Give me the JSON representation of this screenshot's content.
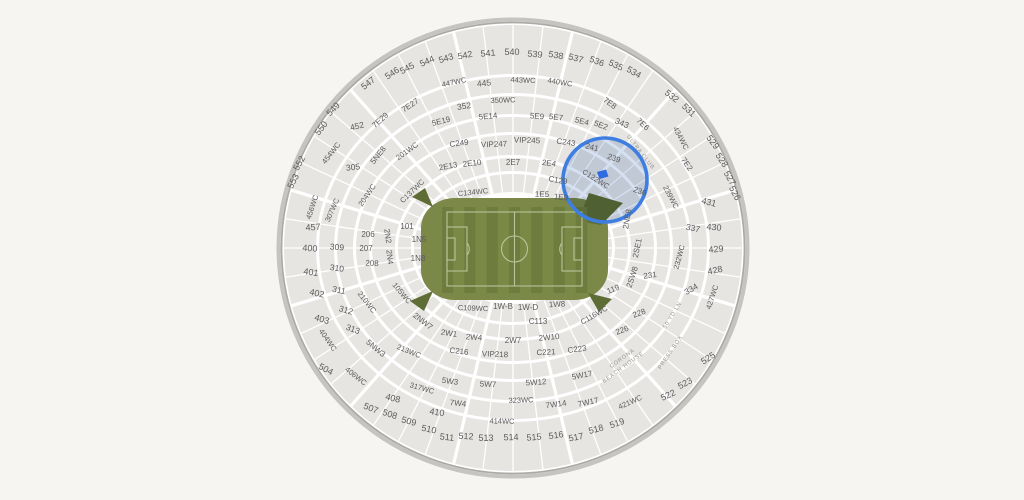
{
  "map": {
    "venue_hint": "stadium-seat-map",
    "colors": {
      "background": "#f7f5f1",
      "bowl_base": "#ffffff",
      "section_fill": "#e7e5e2",
      "rim_outer": "#c6c4c1",
      "rim_inner": "#abaaa7",
      "label": "#5b5b5b",
      "amenity_label": "#97948e",
      "field_apron": "#7b8847",
      "stripe_a": "#6e7c3d",
      "stripe_b": "#7a8946",
      "field_lines": "#b9c49b",
      "ramp": "#5e6d35"
    },
    "highlight": {
      "cx": 605,
      "cy": 180,
      "r": 42,
      "ring_color": "#3e7ee2",
      "tint_color": "#b9cbe7",
      "marker_color": "#2c6be2",
      "sections": [
        "241",
        "239",
        "C122WC"
      ]
    },
    "labels": [
      {
        "t": "546",
        "x": 392,
        "y": 73,
        "r": -33,
        "s": 9
      },
      {
        "t": "545",
        "x": 407,
        "y": 68,
        "r": -28,
        "s": 9
      },
      {
        "t": "544",
        "x": 427,
        "y": 61,
        "r": -23,
        "s": 9
      },
      {
        "t": "543",
        "x": 446,
        "y": 58,
        "r": -17,
        "s": 9
      },
      {
        "t": "542",
        "x": 465,
        "y": 55,
        "r": -11,
        "s": 9
      },
      {
        "t": "541",
        "x": 488,
        "y": 53,
        "r": -5,
        "s": 9
      },
      {
        "t": "540",
        "x": 512,
        "y": 52,
        "r": 0,
        "s": 9
      },
      {
        "t": "539",
        "x": 535,
        "y": 54,
        "r": 5,
        "s": 9
      },
      {
        "t": "538",
        "x": 556,
        "y": 55,
        "r": 10,
        "s": 9
      },
      {
        "t": "537",
        "x": 576,
        "y": 58,
        "r": 15,
        "s": 9
      },
      {
        "t": "536",
        "x": 597,
        "y": 61,
        "r": 20,
        "s": 9
      },
      {
        "t": "535",
        "x": 616,
        "y": 65,
        "r": 25,
        "s": 9
      },
      {
        "t": "534",
        "x": 634,
        "y": 72,
        "r": 30,
        "s": 9
      },
      {
        "t": "547",
        "x": 368,
        "y": 83,
        "r": -38,
        "s": 9
      },
      {
        "t": "549",
        "x": 333,
        "y": 109,
        "r": -47,
        "s": 9
      },
      {
        "t": "550",
        "x": 321,
        "y": 128,
        "r": -52,
        "s": 9
      },
      {
        "t": "552",
        "x": 299,
        "y": 163,
        "r": -60,
        "s": 9
      },
      {
        "t": "553",
        "x": 293,
        "y": 181,
        "r": -63,
        "s": 9
      },
      {
        "t": "532",
        "x": 672,
        "y": 96,
        "r": 38,
        "s": 9
      },
      {
        "t": "531",
        "x": 689,
        "y": 110,
        "r": 44,
        "s": 9
      },
      {
        "t": "529",
        "x": 713,
        "y": 142,
        "r": 53,
        "s": 9
      },
      {
        "t": "528",
        "x": 722,
        "y": 160,
        "r": 57,
        "s": 9
      },
      {
        "t": "527",
        "x": 730,
        "y": 178,
        "r": 60,
        "s": 9
      },
      {
        "t": "526",
        "x": 735,
        "y": 193,
        "r": 63,
        "s": 9
      },
      {
        "t": "504",
        "x": 326,
        "y": 369,
        "r": 28,
        "s": 9
      },
      {
        "t": "507",
        "x": 371,
        "y": 408,
        "r": 22,
        "s": 9
      },
      {
        "t": "508",
        "x": 390,
        "y": 414,
        "r": 18,
        "s": 9
      },
      {
        "t": "509",
        "x": 409,
        "y": 421,
        "r": 15,
        "s": 9
      },
      {
        "t": "510",
        "x": 429,
        "y": 429,
        "r": 11,
        "s": 9
      },
      {
        "t": "511",
        "x": 447,
        "y": 437,
        "r": 6,
        "s": 9
      },
      {
        "t": "512",
        "x": 466,
        "y": 436,
        "r": 3,
        "s": 9
      },
      {
        "t": "513",
        "x": 486,
        "y": 438,
        "r": 0,
        "s": 9
      },
      {
        "t": "514",
        "x": 511,
        "y": 437,
        "r": -2,
        "s": 9
      },
      {
        "t": "515",
        "x": 534,
        "y": 437,
        "r": -5,
        "s": 9
      },
      {
        "t": "516",
        "x": 556,
        "y": 435,
        "r": -8,
        "s": 9
      },
      {
        "t": "517",
        "x": 576,
        "y": 437,
        "r": -11,
        "s": 9
      },
      {
        "t": "518",
        "x": 596,
        "y": 429,
        "r": -15,
        "s": 9
      },
      {
        "t": "519",
        "x": 617,
        "y": 423,
        "r": -19,
        "s": 9
      },
      {
        "t": "522",
        "x": 668,
        "y": 395,
        "r": -25,
        "s": 9
      },
      {
        "t": "523",
        "x": 685,
        "y": 383,
        "r": -28,
        "s": 9
      },
      {
        "t": "525",
        "x": 708,
        "y": 358,
        "r": -33,
        "s": 9
      },
      {
        "t": "400",
        "x": 310,
        "y": 248,
        "r": 4,
        "s": 9
      },
      {
        "t": "401",
        "x": 311,
        "y": 272,
        "r": 8,
        "s": 9
      },
      {
        "t": "402",
        "x": 317,
        "y": 293,
        "r": 12,
        "s": 9
      },
      {
        "t": "403",
        "x": 322,
        "y": 319,
        "r": 17,
        "s": 9
      },
      {
        "t": "457",
        "x": 313,
        "y": 227,
        "r": -4,
        "s": 9
      },
      {
        "t": "408",
        "x": 393,
        "y": 398,
        "r": 14,
        "s": 9
      },
      {
        "t": "410",
        "x": 437,
        "y": 412,
        "r": 9,
        "s": 9
      },
      {
        "t": "428",
        "x": 715,
        "y": 270,
        "r": -12,
        "s": 9
      },
      {
        "t": "429",
        "x": 716,
        "y": 249,
        "r": -5,
        "s": 9
      },
      {
        "t": "430",
        "x": 714,
        "y": 227,
        "r": 5,
        "s": 9
      },
      {
        "t": "431",
        "x": 709,
        "y": 202,
        "r": 14,
        "s": 9
      },
      {
        "t": "305",
        "x": 353,
        "y": 167,
        "r": -6,
        "s": 8.5
      },
      {
        "t": "309",
        "x": 337,
        "y": 247,
        "r": 5,
        "s": 8.5
      },
      {
        "t": "310",
        "x": 337,
        "y": 268,
        "r": 8,
        "s": 8.5
      },
      {
        "t": "311",
        "x": 339,
        "y": 290,
        "r": 12,
        "s": 8.5
      },
      {
        "t": "312",
        "x": 346,
        "y": 310,
        "r": 16,
        "s": 8.5
      },
      {
        "t": "313",
        "x": 353,
        "y": 329,
        "r": 20,
        "s": 8.5
      },
      {
        "t": "334",
        "x": 691,
        "y": 289,
        "r": -30,
        "s": 8.5
      },
      {
        "t": "337",
        "x": 693,
        "y": 228,
        "r": 12,
        "s": 8.5
      },
      {
        "t": "343",
        "x": 622,
        "y": 123,
        "r": 24,
        "s": 8.5
      },
      {
        "t": "352",
        "x": 464,
        "y": 106,
        "r": -8,
        "s": 8.5
      },
      {
        "t": "445",
        "x": 484,
        "y": 83,
        "r": -6,
        "s": 8.5
      },
      {
        "t": "452",
        "x": 357,
        "y": 126,
        "r": -14,
        "s": 8.5
      },
      {
        "t": "447WC",
        "x": 454,
        "y": 82,
        "r": -12,
        "s": 7.5
      },
      {
        "t": "443WC",
        "x": 523,
        "y": 80,
        "r": 2,
        "s": 7.5
      },
      {
        "t": "440WC",
        "x": 560,
        "y": 82,
        "r": 9,
        "s": 7.5
      },
      {
        "t": "434WC",
        "x": 681,
        "y": 138,
        "r": 62,
        "s": 7.5
      },
      {
        "t": "427WC",
        "x": 712,
        "y": 297,
        "r": -72,
        "s": 7.5
      },
      {
        "t": "421WC",
        "x": 630,
        "y": 402,
        "r": -24,
        "s": 7.5
      },
      {
        "t": "414WC",
        "x": 502,
        "y": 421,
        "r": 1,
        "s": 7.5
      },
      {
        "t": "406WC",
        "x": 356,
        "y": 376,
        "r": 38,
        "s": 7.5
      },
      {
        "t": "404WC",
        "x": 328,
        "y": 340,
        "r": 55,
        "s": 7.5
      },
      {
        "t": "454WC",
        "x": 331,
        "y": 153,
        "r": -52,
        "s": 7.5
      },
      {
        "t": "456WC",
        "x": 312,
        "y": 207,
        "r": -72,
        "s": 7.5
      },
      {
        "t": "350WC",
        "x": 503,
        "y": 100,
        "r": -2,
        "s": 7.5
      },
      {
        "t": "317WC",
        "x": 422,
        "y": 388,
        "r": 16,
        "s": 7.5
      },
      {
        "t": "323WC",
        "x": 521,
        "y": 400,
        "r": -2,
        "s": 7.5
      },
      {
        "t": "307WC",
        "x": 332,
        "y": 210,
        "r": -66,
        "s": 7.5
      },
      {
        "t": "201WC",
        "x": 407,
        "y": 151,
        "r": -36,
        "s": 7.5
      },
      {
        "t": "204WC",
        "x": 367,
        "y": 195,
        "r": -56,
        "s": 7.5
      },
      {
        "t": "210WC",
        "x": 367,
        "y": 302,
        "r": 52,
        "s": 7.5
      },
      {
        "t": "213WC",
        "x": 409,
        "y": 351,
        "r": 22,
        "s": 7.5
      },
      {
        "t": "105WC",
        "x": 402,
        "y": 293,
        "r": 50,
        "s": 7.5
      },
      {
        "t": "C137WC",
        "x": 412,
        "y": 191,
        "r": -44,
        "s": 7.5
      },
      {
        "t": "C134WC",
        "x": 473,
        "y": 192,
        "r": -6,
        "s": 7.5
      },
      {
        "t": "C109WC",
        "x": 473,
        "y": 308,
        "r": 2,
        "s": 7.5
      },
      {
        "t": "C116WC",
        "x": 594,
        "y": 315,
        "r": -30,
        "s": 7.5
      },
      {
        "t": "C122WC",
        "x": 596,
        "y": 179,
        "r": 32,
        "s": 7.5
      },
      {
        "t": "232WC",
        "x": 679,
        "y": 257,
        "r": -75,
        "s": 7.5
      },
      {
        "t": "239WC",
        "x": 671,
        "y": 197,
        "r": 62,
        "s": 7.5
      },
      {
        "t": "5E19",
        "x": 441,
        "y": 121,
        "r": -14
      },
      {
        "t": "5E14",
        "x": 488,
        "y": 116,
        "r": -5
      },
      {
        "t": "5E9",
        "x": 537,
        "y": 116,
        "r": 4
      },
      {
        "t": "5E7",
        "x": 556,
        "y": 117,
        "r": 7
      },
      {
        "t": "5E4",
        "x": 582,
        "y": 121,
        "r": 14
      },
      {
        "t": "5E2",
        "x": 601,
        "y": 125,
        "r": 20
      },
      {
        "t": "7E29",
        "x": 380,
        "y": 120,
        "r": -42
      },
      {
        "t": "7E27",
        "x": 410,
        "y": 105,
        "r": -34
      },
      {
        "t": "7E8",
        "x": 610,
        "y": 103,
        "r": 36
      },
      {
        "t": "7E6",
        "x": 643,
        "y": 124,
        "r": 44
      },
      {
        "t": "7E2",
        "x": 687,
        "y": 164,
        "r": 55
      },
      {
        "t": "5NE8",
        "x": 378,
        "y": 155,
        "r": -52
      },
      {
        "t": "5NW3",
        "x": 376,
        "y": 348,
        "r": 40
      },
      {
        "t": "5W3",
        "x": 450,
        "y": 381,
        "r": 8
      },
      {
        "t": "5W7",
        "x": 488,
        "y": 384,
        "r": 3
      },
      {
        "t": "5W12",
        "x": 536,
        "y": 382,
        "r": -4
      },
      {
        "t": "5W17",
        "x": 582,
        "y": 375,
        "r": -11
      },
      {
        "t": "7W4",
        "x": 458,
        "y": 403,
        "r": 6
      },
      {
        "t": "7W14",
        "x": 556,
        "y": 404,
        "r": -8
      },
      {
        "t": "7W17",
        "x": 588,
        "y": 402,
        "r": -12
      },
      {
        "t": "2NW7",
        "x": 423,
        "y": 321,
        "r": 38
      },
      {
        "t": "2NE8",
        "x": 627,
        "y": 219,
        "r": -80
      },
      {
        "t": "2SE1",
        "x": 637,
        "y": 248,
        "r": -78
      },
      {
        "t": "2SW8",
        "x": 632,
        "y": 277,
        "r": -72
      },
      {
        "t": "C249",
        "x": 459,
        "y": 143,
        "r": -7
      },
      {
        "t": "VIP247",
        "x": 494,
        "y": 144,
        "r": -2
      },
      {
        "t": "VIP245",
        "x": 527,
        "y": 140,
        "r": 2
      },
      {
        "t": "C243",
        "x": 566,
        "y": 142,
        "r": 8
      },
      {
        "t": "241",
        "x": 592,
        "y": 147,
        "r": 14
      },
      {
        "t": "239",
        "x": 614,
        "y": 158,
        "r": 20
      },
      {
        "t": "C216",
        "x": 459,
        "y": 351,
        "r": 6
      },
      {
        "t": "VIP218",
        "x": 495,
        "y": 354,
        "r": 2
      },
      {
        "t": "C221",
        "x": 546,
        "y": 352,
        "r": -3
      },
      {
        "t": "C223",
        "x": 577,
        "y": 349,
        "r": -7
      },
      {
        "t": "226",
        "x": 622,
        "y": 330,
        "r": -20
      },
      {
        "t": "228",
        "x": 639,
        "y": 313,
        "r": -20
      },
      {
        "t": "231",
        "x": 650,
        "y": 275,
        "r": -8
      },
      {
        "t": "236",
        "x": 640,
        "y": 191,
        "r": 18
      },
      {
        "t": "206",
        "x": 368,
        "y": 234,
        "r": 0
      },
      {
        "t": "207",
        "x": 366,
        "y": 248,
        "r": 0
      },
      {
        "t": "208",
        "x": 372,
        "y": 263,
        "r": 2
      },
      {
        "t": "2E13",
        "x": 448,
        "y": 166,
        "r": -11
      },
      {
        "t": "2E10",
        "x": 472,
        "y": 163,
        "r": -6
      },
      {
        "t": "2E7",
        "x": 513,
        "y": 162,
        "r": 0
      },
      {
        "t": "2E4",
        "x": 549,
        "y": 163,
        "r": 7
      },
      {
        "t": "C129",
        "x": 558,
        "y": 180,
        "r": 10
      },
      {
        "t": "2W1",
        "x": 449,
        "y": 333,
        "r": 8
      },
      {
        "t": "2W4",
        "x": 474,
        "y": 337,
        "r": 4
      },
      {
        "t": "2W7",
        "x": 513,
        "y": 340,
        "r": 0
      },
      {
        "t": "2W10",
        "x": 549,
        "y": 337,
        "r": -5
      },
      {
        "t": "2N2",
        "x": 388,
        "y": 236,
        "r": 82
      },
      {
        "t": "2N4",
        "x": 390,
        "y": 257,
        "r": 84
      },
      {
        "t": "101",
        "x": 407,
        "y": 226,
        "r": 0
      },
      {
        "t": "1N5",
        "x": 419,
        "y": 239,
        "r": 0
      },
      {
        "t": "1N8",
        "x": 418,
        "y": 258,
        "r": 0
      },
      {
        "t": "1E5",
        "x": 542,
        "y": 194,
        "r": 2
      },
      {
        "t": "1E9",
        "x": 561,
        "y": 197,
        "r": 6
      },
      {
        "t": "119",
        "x": 613,
        "y": 289,
        "r": -22
      },
      {
        "t": "C113",
        "x": 538,
        "y": 321,
        "r": 0
      },
      {
        "t": "1W-B",
        "x": 503,
        "y": 306,
        "r": 0
      },
      {
        "t": "1W-D",
        "x": 528,
        "y": 307,
        "r": 0
      },
      {
        "t": "1W8",
        "x": 557,
        "y": 304,
        "r": -3
      }
    ],
    "amenity_labels": [
      {
        "t": "ULTRA CLUB",
        "x": 641,
        "y": 152,
        "r": 52
      },
      {
        "t": "PRESS BOX",
        "x": 670,
        "y": 352,
        "r": -56
      },
      {
        "t": "50 YD LN",
        "x": 672,
        "y": 315,
        "r": -58
      },
      {
        "t": "CORONA",
        "x": 622,
        "y": 358,
        "r": -36
      },
      {
        "t": "BEACH HOUSE",
        "x": 623,
        "y": 367,
        "r": -36
      }
    ]
  }
}
